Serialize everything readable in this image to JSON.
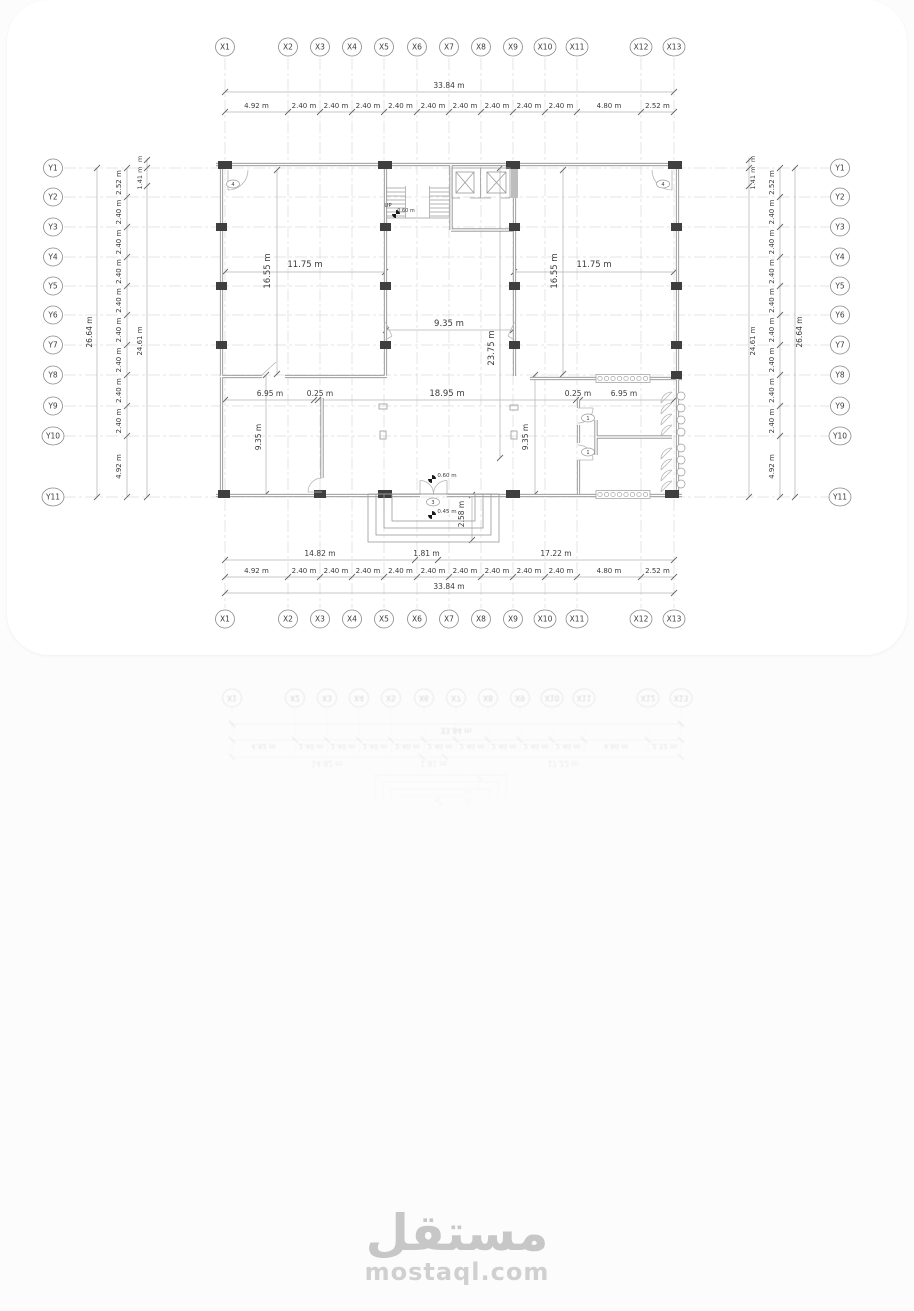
{
  "watermark": {
    "arabic": "مستقل",
    "domain": "mostaql.com"
  },
  "colors": {
    "line": "#b8b8b8",
    "grid": "#d8d8d8",
    "text": "#3a3a3a",
    "wall": "#8d8d8d",
    "column": "#3f3f3f",
    "watermark": "#c7c7c7"
  },
  "plan": {
    "grid": {
      "x_labels": [
        "X1",
        "X2",
        "X3",
        "X4",
        "X5",
        "X6",
        "X7",
        "X8",
        "X9",
        "X10",
        "X11",
        "X12",
        "X13"
      ],
      "y_labels": [
        "Y1",
        "Y2",
        "Y3",
        "Y4",
        "Y5",
        "Y6",
        "Y7",
        "Y8",
        "Y9",
        "Y10",
        "Y11"
      ]
    },
    "dims": {
      "x_total": "33.84 m",
      "x_segments": [
        "4.92 m",
        "2.40 m",
        "2.40 m",
        "2.40 m",
        "2.40 m",
        "2.40 m",
        "2.40 m",
        "2.40 m",
        "2.40 m",
        "2.40 m",
        "4.80 m",
        "2.52 m"
      ],
      "x_sub": [
        "14.82 m",
        "1.81 m",
        "17.22 m"
      ],
      "y_total": "26.64 m",
      "y_segments": [
        "2.52 m",
        "2.40 m",
        "2.40 m",
        "2.40 m",
        "2.40 m",
        "2.40 m",
        "2.40 m",
        "2.40 m",
        "2.40 m",
        "4.92 m"
      ],
      "y_inner": [
        "m",
        "1.41 m",
        "24.61 m"
      ]
    },
    "labels": {
      "left_room_w": "11.75 m",
      "left_room_h": "16.55 m",
      "right_room_w": "11.75 m",
      "right_room_h": "16.55 m",
      "hall_w": "9.35 m",
      "hall_h": "23.75 m",
      "lower_w": "18.95 m",
      "ll_a": "6.95 m",
      "ll_b": "0.25 m",
      "ll_h": "9.35 m",
      "lr_a": "0.25 m",
      "lr_b": "6.95 m",
      "lr_h": "9.35 m",
      "entry_d": "2.58 m",
      "lvl_a": "0.60 m",
      "lvl_b": "0.45 m",
      "lvl_c": "0.60 m",
      "up": "UP",
      "tag_door_left": "4",
      "tag_door_right": "4",
      "tag_entry": "3",
      "tag_wc1": "1",
      "tag_wc2": "1"
    }
  }
}
